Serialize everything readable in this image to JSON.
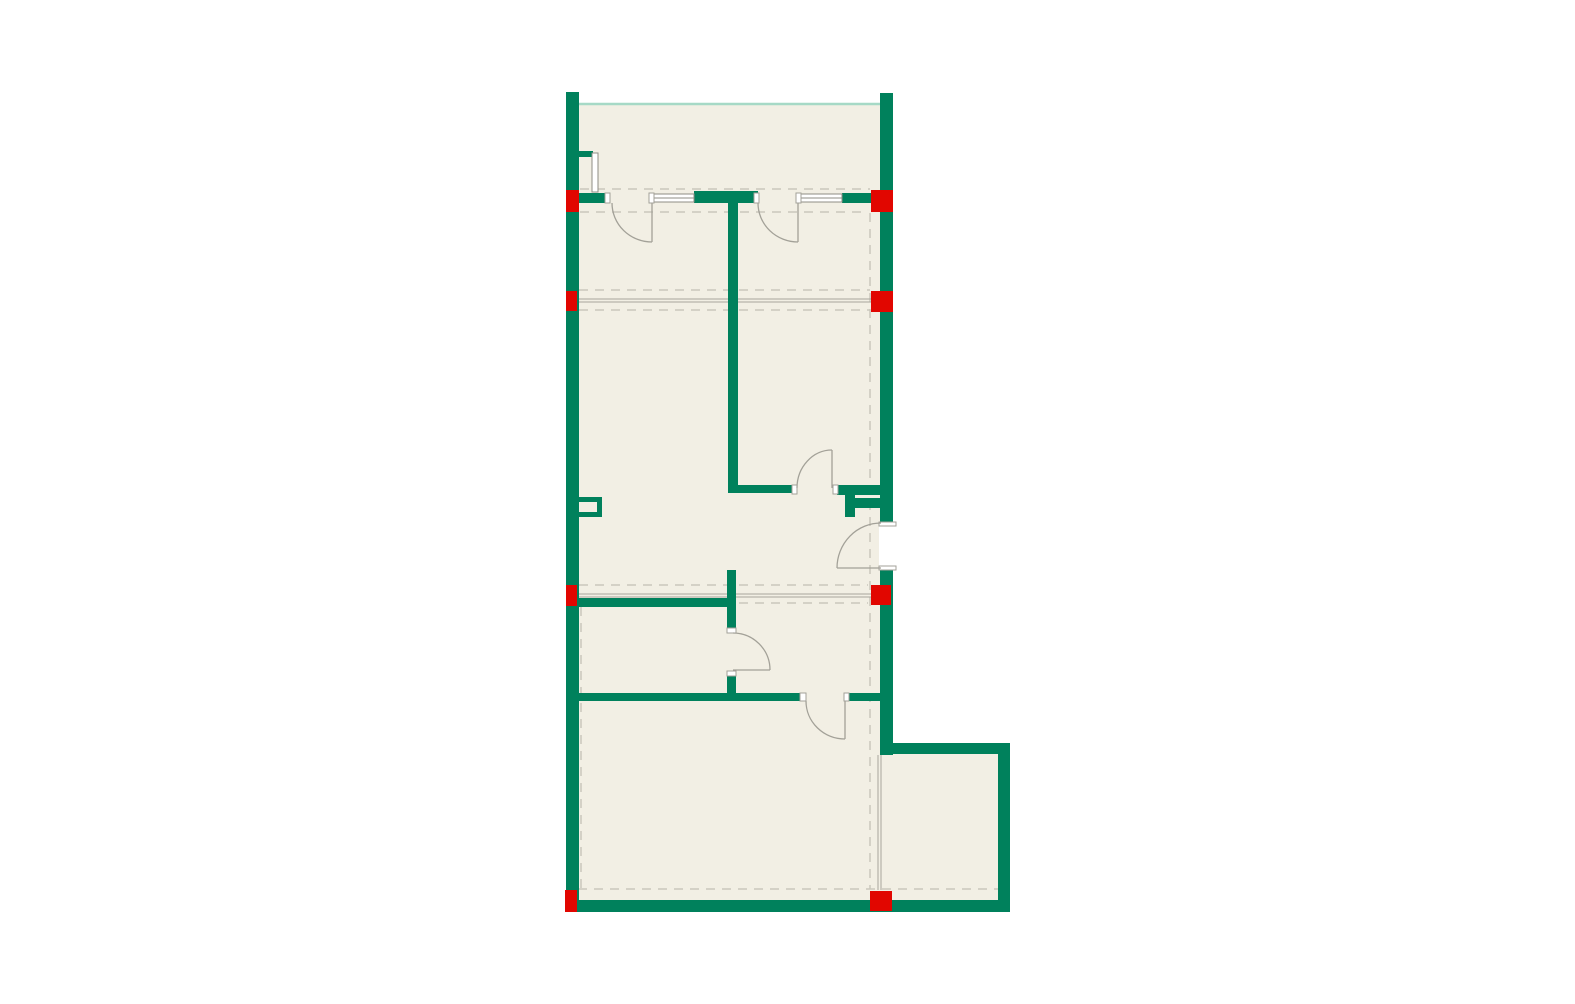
{
  "canvas": {
    "width": 1575,
    "height": 1004,
    "background": "#ffffff"
  },
  "palette": {
    "wall_green": "#00815c",
    "column_red": "#e10600",
    "floor_cream": "#f2efe4",
    "dash_gray": "#cac7bc",
    "beam_gray": "#a8a69d",
    "symbol_gray": "#a3a198",
    "window_gray": "#8f8d85",
    "terrace_teal": "#a6d9c6",
    "opening_white": "#ffffff"
  },
  "floors": [
    {
      "name": "floor-main",
      "x": 579,
      "y": 103,
      "w": 301,
      "h": 797
    },
    {
      "name": "floor-annex",
      "x": 880,
      "y": 754,
      "w": 119,
      "h": 146
    }
  ],
  "terrace_lines": [
    {
      "name": "terrace-edge-line",
      "pts": [
        579,
        104,
        880,
        104
      ]
    }
  ],
  "dashed_lines": [
    {
      "name": "dash-top-outer",
      "pts": [
        580,
        189,
        870,
        189
      ]
    },
    {
      "name": "dash-top-inner",
      "pts": [
        580,
        212,
        868,
        212
      ]
    },
    {
      "name": "dash-beam1-upper",
      "pts": [
        579,
        290,
        870,
        290
      ]
    },
    {
      "name": "dash-beam1-lower",
      "pts": [
        579,
        310,
        870,
        310
      ]
    },
    {
      "name": "dash-beam2-upper",
      "pts": [
        579,
        585,
        868,
        585
      ]
    },
    {
      "name": "dash-beam2-lower",
      "pts": [
        579,
        603,
        868,
        603
      ]
    },
    {
      "name": "dash-bottom",
      "pts": [
        578,
        889,
        998,
        889
      ]
    },
    {
      "name": "dash-right-vertical",
      "pts": [
        870,
        213,
        870,
        889
      ]
    },
    {
      "name": "dash-left-vertical",
      "pts": [
        581,
        607,
        581,
        889
      ]
    }
  ],
  "beam_lines": [
    {
      "name": "beam-line-1a",
      "pts": [
        579,
        299,
        872,
        299
      ]
    },
    {
      "name": "beam-line-1b",
      "pts": [
        579,
        302,
        872,
        302
      ]
    },
    {
      "name": "beam-line-2a",
      "pts": [
        579,
        594,
        872,
        594
      ]
    },
    {
      "name": "beam-line-2b",
      "pts": [
        579,
        597,
        872,
        597
      ]
    },
    {
      "name": "annex-face-line-a",
      "pts": [
        878,
        755,
        878,
        890
      ]
    },
    {
      "name": "annex-face-line-b",
      "pts": [
        881,
        755,
        881,
        890
      ]
    }
  ],
  "walls": [
    {
      "name": "wall-left",
      "x": 566,
      "y": 92,
      "w": 13,
      "h": 820
    },
    {
      "name": "wall-right-upper",
      "x": 880,
      "y": 93,
      "w": 13,
      "h": 429
    },
    {
      "name": "wall-right-lower",
      "x": 880,
      "y": 570,
      "w": 13,
      "h": 185
    },
    {
      "name": "wall-bottom",
      "x": 566,
      "y": 900,
      "w": 444,
      "h": 12
    },
    {
      "name": "wall-annex-top",
      "x": 880,
      "y": 743,
      "w": 130,
      "h": 11
    },
    {
      "name": "wall-annex-right",
      "x": 998,
      "y": 743,
      "w": 12,
      "h": 169
    },
    {
      "name": "wall-top-seg-a",
      "x": 579,
      "y": 193,
      "w": 30,
      "h": 10
    },
    {
      "name": "wall-top-lintel",
      "x": 694,
      "y": 191,
      "w": 64,
      "h": 12
    },
    {
      "name": "wall-top-seg-b",
      "x": 842,
      "y": 193,
      "w": 38,
      "h": 10
    },
    {
      "name": "wall-core-vertical",
      "x": 728,
      "y": 193,
      "w": 10,
      "h": 299
    },
    {
      "name": "wall-mid-horizontal",
      "x": 728,
      "y": 485,
      "w": 65,
      "h": 8
    },
    {
      "name": "wall-shaft-top",
      "x": 837,
      "y": 485,
      "w": 43,
      "h": 10
    },
    {
      "name": "wall-shaft-stem",
      "x": 845,
      "y": 490,
      "w": 10,
      "h": 27
    },
    {
      "name": "wall-shaft-nub",
      "x": 855,
      "y": 498,
      "w": 25,
      "h": 10
    },
    {
      "name": "wall-bath-top",
      "x": 576,
      "y": 598,
      "w": 157,
      "h": 9
    },
    {
      "name": "wall-stub-upper",
      "x": 727,
      "y": 570,
      "w": 9,
      "h": 58
    },
    {
      "name": "wall-stub-lower",
      "x": 727,
      "y": 676,
      "w": 9,
      "h": 19
    },
    {
      "name": "wall-hall-bottom-left",
      "x": 576,
      "y": 693,
      "w": 230,
      "h": 8
    },
    {
      "name": "wall-hall-bottom-right",
      "x": 844,
      "y": 693,
      "w": 36,
      "h": 8
    },
    {
      "name": "wall-terrace-stub",
      "x": 579,
      "y": 151,
      "w": 14,
      "h": 6
    },
    {
      "name": "niche-top",
      "x": 576,
      "y": 497,
      "w": 26,
      "h": 5
    },
    {
      "name": "niche-right",
      "x": 597,
      "y": 497,
      "w": 5,
      "h": 20
    },
    {
      "name": "niche-bottom",
      "x": 576,
      "y": 512,
      "w": 26,
      "h": 5
    }
  ],
  "columns": [
    {
      "name": "column-top-left",
      "x": 566,
      "y": 190,
      "w": 13,
      "h": 22
    },
    {
      "name": "column-top-right",
      "x": 871,
      "y": 190,
      "w": 22,
      "h": 22
    },
    {
      "name": "column-beam1-left",
      "x": 566,
      "y": 291,
      "w": 11,
      "h": 20
    },
    {
      "name": "column-beam1-right",
      "x": 871,
      "y": 291,
      "w": 22,
      "h": 21
    },
    {
      "name": "column-beam2-left",
      "x": 566,
      "y": 585,
      "w": 11,
      "h": 21
    },
    {
      "name": "column-beam2-right",
      "x": 871,
      "y": 585,
      "w": 20,
      "h": 20
    },
    {
      "name": "column-bottom-left",
      "x": 565,
      "y": 890,
      "w": 12,
      "h": 22
    },
    {
      "name": "column-bottom-right",
      "x": 870,
      "y": 891,
      "w": 22,
      "h": 20
    }
  ],
  "openings": [
    {
      "name": "opening-right-wall-door",
      "x": 879,
      "y": 522,
      "w": 17,
      "h": 48
    }
  ],
  "windows": [
    {
      "name": "window-bedroom-1",
      "x": 652,
      "y": 194,
      "w": 42,
      "h": 8
    },
    {
      "name": "window-bedroom-2",
      "x": 800,
      "y": 194,
      "w": 42,
      "h": 8
    },
    {
      "name": "terrace-partition-glass",
      "x": 592,
      "y": 153,
      "w": 6,
      "h": 39
    }
  ],
  "window_lines": [
    {
      "name": "window-1-midline",
      "pts": [
        652,
        198,
        694,
        198
      ]
    },
    {
      "name": "window-2-midline",
      "pts": [
        800,
        198,
        842,
        198
      ]
    }
  ],
  "jambs": [
    {
      "name": "jamb-door1-left",
      "x": 605,
      "y": 193,
      "w": 5,
      "h": 10
    },
    {
      "name": "jamb-door1-right",
      "x": 649,
      "y": 193,
      "w": 5,
      "h": 10
    },
    {
      "name": "jamb-door2-left",
      "x": 754,
      "y": 193,
      "w": 5,
      "h": 10
    },
    {
      "name": "jamb-door2-right",
      "x": 796,
      "y": 193,
      "w": 5,
      "h": 10
    },
    {
      "name": "jamb-midwall-left",
      "x": 792,
      "y": 485,
      "w": 5,
      "h": 9
    },
    {
      "name": "jamb-midwall-right",
      "x": 833,
      "y": 485,
      "w": 5,
      "h": 9
    },
    {
      "name": "jamb-rightwall-top",
      "x": 879,
      "y": 522,
      "w": 17,
      "h": 4
    },
    {
      "name": "jamb-rightwall-bottom",
      "x": 879,
      "y": 566,
      "w": 17,
      "h": 4
    },
    {
      "name": "jamb-stub-top",
      "x": 727,
      "y": 628,
      "w": 9,
      "h": 5
    },
    {
      "name": "jamb-stub-bottom",
      "x": 727,
      "y": 671,
      "w": 9,
      "h": 5
    },
    {
      "name": "jamb-hall-left",
      "x": 800,
      "y": 693,
      "w": 6,
      "h": 8
    },
    {
      "name": "jamb-hall-right",
      "x": 844,
      "y": 693,
      "w": 5,
      "h": 8
    }
  ],
  "doors": [
    {
      "name": "door-bedroom-1",
      "arc": [
        612,
        203,
        40,
        39,
        0,
        652,
        242
      ],
      "leaf": [
        652,
        203,
        652,
        242
      ]
    },
    {
      "name": "door-bedroom-2",
      "arc": [
        758,
        203,
        40,
        39,
        0,
        798,
        242
      ],
      "leaf": [
        798,
        203,
        798,
        242
      ]
    },
    {
      "name": "door-right-wall",
      "arc": [
        837,
        568,
        44,
        45,
        1,
        881,
        523
      ],
      "leaf": [
        837,
        568,
        881,
        568
      ]
    },
    {
      "name": "door-stub-wall",
      "arc": [
        733,
        633,
        37,
        37,
        1,
        770,
        670
      ],
      "leaf": [
        733,
        670,
        770,
        670
      ]
    },
    {
      "name": "door-living-hall",
      "arc": [
        806,
        701,
        39,
        38,
        0,
        845,
        739
      ],
      "leaf": [
        845,
        701,
        845,
        739
      ]
    },
    {
      "name": "door-mid-wall",
      "arc": [
        797,
        488,
        35,
        38,
        1,
        832,
        450
      ],
      "leaf": [
        832,
        450,
        832,
        488
      ]
    }
  ]
}
